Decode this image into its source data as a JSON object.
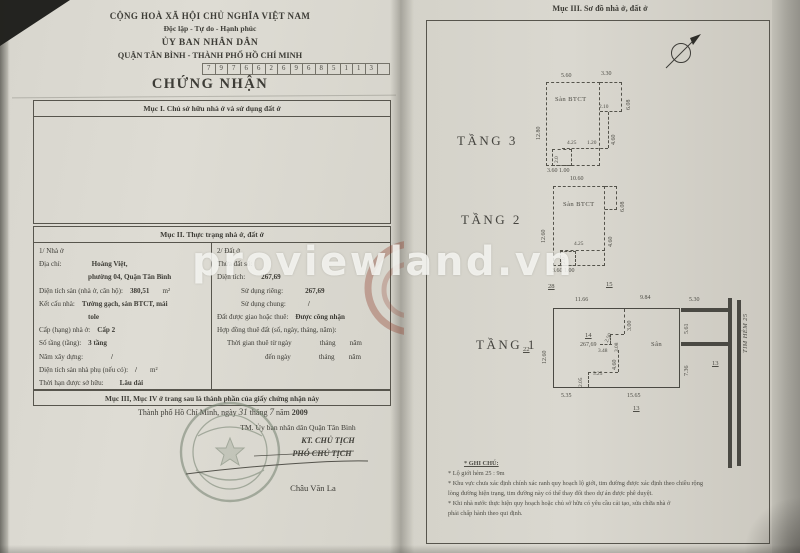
{
  "watermark": "proviewland.vn",
  "left": {
    "header": {
      "country": "CỘNG HOÀ XÃ HỘI CHỦ NGHĨA VIỆT NAM",
      "motto": "Độc lập - Tự do - Hạnh phúc",
      "issuer": "ỦY BAN NHÂN DÂN",
      "issuer2": "QUẬN TÂN BÌNH - THÀNH PHỐ HỒ CHÍ MINH",
      "code_digits": [
        "7",
        "9",
        "7",
        "6",
        "6",
        "2",
        "6",
        "9",
        "6",
        "8",
        "5",
        "1",
        "1",
        "3"
      ],
      "title": "CHỨNG NHẬN"
    },
    "muc1_heading": "Mục I. Chủ sở hữu nhà ở và sử dụng đất ở",
    "muc2_heading": "Mục II. Thực trạng nhà ở, đất ở",
    "house_rows": [
      {
        "l": "1/ Nhà ở"
      },
      {
        "l": "Địa chỉ:",
        "v": "Hoàng Việt,",
        "vml": 30
      },
      {
        "v": "phường 04, Quận Tân Bình",
        "ind": 42
      },
      {
        "l": "Diện tích sàn (nhà ở, căn hộ):",
        "v": "380,51",
        "u": "m²"
      },
      {
        "l": "Kết cấu nhà:",
        "v": "Tường gạch, sàn BTCT, mái"
      },
      {
        "v": "tole",
        "ind": 42
      },
      {
        "l": "Cấp (hạng) nhà ở:",
        "v": "Cấp 2"
      },
      {
        "l": "Số tầng (tầng):",
        "v": "3 tầng"
      },
      {
        "l": "Năm xây dựng:",
        "v": "/",
        "vml": 28
      },
      {
        "l": "Diện tích sàn nhà phụ (nếu có):",
        "v": "/",
        "u": "m²"
      },
      {
        "l": "Thời hạn được sở hữu:",
        "v": "Lâu dài",
        "vml": 16
      }
    ],
    "land_rows": [
      {
        "l": "2/ Đất ở"
      },
      {
        "l": "Thửa đất số:"
      },
      {
        "l": "Diện tích:",
        "v": "267,69",
        "vml": 16
      },
      {
        "l": "Sử dụng riêng:",
        "v": "267,69",
        "ind": 24,
        "vml": 22
      },
      {
        "l": "Sử dụng chung:",
        "v": "/",
        "ind": 24,
        "vml": 22
      },
      {
        "l": "Đất được giao hoặc thuê:",
        "v": "Được công nhận"
      },
      {
        "l": "Hợp đồng thuê đất (số, ngày, tháng, năm):"
      },
      {
        "l": "Thời gian thuê từ ngày",
        "v": "tháng        năm",
        "cls": "plain",
        "vml": 28,
        "ind": 10
      },
      {
        "l": "đến ngày",
        "v": "tháng        năm",
        "cls": "plain",
        "vml": 28,
        "ind": 48
      }
    ],
    "muc34_note": "Mục III, Mục IV ở trang sau là thành phần của giấy chứng nhận này",
    "date_line": {
      "place": "Thành phố Hồ Chí Minh,",
      "ngay_label": "ngày",
      "day": "31",
      "thang_label": "tháng",
      "month": "7",
      "nam_label": "năm",
      "year": "2009"
    },
    "sign_block": {
      "tm": "TM. Ủy ban nhân dân Quận Tân Bình",
      "kt": "KT. CHỦ TỊCH",
      "pho": "PHÓ CHỦ TỊCH",
      "name": "Châu Văn La"
    }
  },
  "right": {
    "heading": "Mục III. Sơ đồ nhà ở, đất ở",
    "plan_labels": [
      {
        "t": "TẦNG 3",
        "x": 457,
        "y": 133,
        "cls": "floor"
      },
      {
        "t": "5.60",
        "x": 561,
        "y": 73
      },
      {
        "t": "3.30",
        "x": 601,
        "y": 71
      },
      {
        "t": "6.08",
        "x": 626,
        "y": 110,
        "r": -90
      },
      {
        "t": "2.10",
        "x": 599,
        "y": 104,
        "cls": "tiny"
      },
      {
        "t": "4.60",
        "x": 611,
        "y": 145,
        "r": -90
      },
      {
        "t": "12.80",
        "x": 536,
        "y": 140,
        "r": -90
      },
      {
        "t": "Sàn BTCT",
        "x": 555,
        "y": 96,
        "cls": "room"
      },
      {
        "t": "4.25",
        "x": 567,
        "y": 140,
        "cls": "tiny"
      },
      {
        "t": "1.20",
        "x": 587,
        "y": 140,
        "cls": "tiny"
      },
      {
        "t": "2.0",
        "x": 554,
        "y": 163,
        "r": -90,
        "cls": "tiny"
      },
      {
        "t": "3.60 1.00",
        "x": 547,
        "y": 168
      },
      {
        "t": "TẦNG 2",
        "x": 461,
        "y": 212,
        "cls": "floor"
      },
      {
        "t": "10.60",
        "x": 570,
        "y": 176
      },
      {
        "t": "6.08",
        "x": 620,
        "y": 212,
        "r": -90
      },
      {
        "t": "12.60",
        "x": 541,
        "y": 243,
        "r": -90
      },
      {
        "t": "4.60",
        "x": 608,
        "y": 247,
        "r": -90
      },
      {
        "t": "Sàn BTCT",
        "x": 563,
        "y": 201,
        "cls": "room"
      },
      {
        "t": "4.25",
        "x": 574,
        "y": 241,
        "cls": "tiny"
      },
      {
        "t": "2.0",
        "x": 561,
        "y": 264,
        "r": -90,
        "cls": "tiny"
      },
      {
        "t": "3.60 1.00",
        "x": 552,
        "y": 268
      },
      {
        "t": "TẦNG 1",
        "x": 476,
        "y": 337,
        "cls": "floor"
      },
      {
        "t": "28",
        "x": 548,
        "y": 283,
        "cls": "lot"
      },
      {
        "t": "15",
        "x": 606,
        "y": 281,
        "cls": "lot"
      },
      {
        "t": "11.66",
        "x": 575,
        "y": 297
      },
      {
        "t": "9.84",
        "x": 640,
        "y": 295
      },
      {
        "t": "5.30",
        "x": 689,
        "y": 297
      },
      {
        "t": "5.61",
        "x": 684,
        "y": 334,
        "r": -90
      },
      {
        "t": "TIM HẺM 25",
        "x": 742,
        "y": 353,
        "r": -90,
        "cls": "alley"
      },
      {
        "t": "7.36",
        "x": 684,
        "y": 376,
        "r": -90
      },
      {
        "t": "13",
        "x": 712,
        "y": 360,
        "cls": "lot"
      },
      {
        "t": "22",
        "x": 523,
        "y": 346,
        "cls": "lot"
      },
      {
        "t": "12.60",
        "x": 542,
        "y": 364,
        "r": -90
      },
      {
        "t": "14",
        "x": 585,
        "y": 332,
        "cls": "lot"
      },
      {
        "t": "267,69",
        "x": 580,
        "y": 342
      },
      {
        "t": "Sân",
        "x": 651,
        "y": 341,
        "cls": "room"
      },
      {
        "t": "3.00",
        "x": 627,
        "y": 331,
        "r": -90
      },
      {
        "t": "2.50",
        "x": 604,
        "y": 341,
        "r": -65,
        "cls": "tiny"
      },
      {
        "t": "3.08",
        "x": 614,
        "y": 352,
        "r": -90,
        "cls": "tiny"
      },
      {
        "t": "3.48",
        "x": 598,
        "y": 348,
        "cls": "tiny"
      },
      {
        "t": "4.60",
        "x": 612,
        "y": 370,
        "r": -90
      },
      {
        "t": "5.25",
        "x": 593,
        "y": 371,
        "cls": "tiny"
      },
      {
        "t": "2.05",
        "x": 578,
        "y": 387,
        "r": -90,
        "cls": "tiny"
      },
      {
        "t": "5.35",
        "x": 561,
        "y": 393
      },
      {
        "t": "15.65",
        "x": 627,
        "y": 393
      },
      {
        "t": "13",
        "x": 633,
        "y": 405,
        "cls": "lot"
      }
    ],
    "notes": [
      {
        "t": "* GHI CHÚ:",
        "cls": "ghichu"
      },
      {
        "t": "* Lộ giới hẻm 25 : 9m"
      },
      {
        "t": "* Khu vực chưa xác định chính xác ranh quy hoạch lộ giới, tim đường được xác định theo chiều rộng"
      },
      {
        "t": "lòng đường hiện trạng, tim đường này có thể thay đổi theo dự án được phê duyệt."
      },
      {
        "t": "* Khi nhà nước thực hiện quy hoạch hoặc chủ sở hữu có yêu cầu cải tạo, sửa chữa nhà ở"
      },
      {
        "t": "phải chấp hành theo qui định."
      }
    ]
  }
}
